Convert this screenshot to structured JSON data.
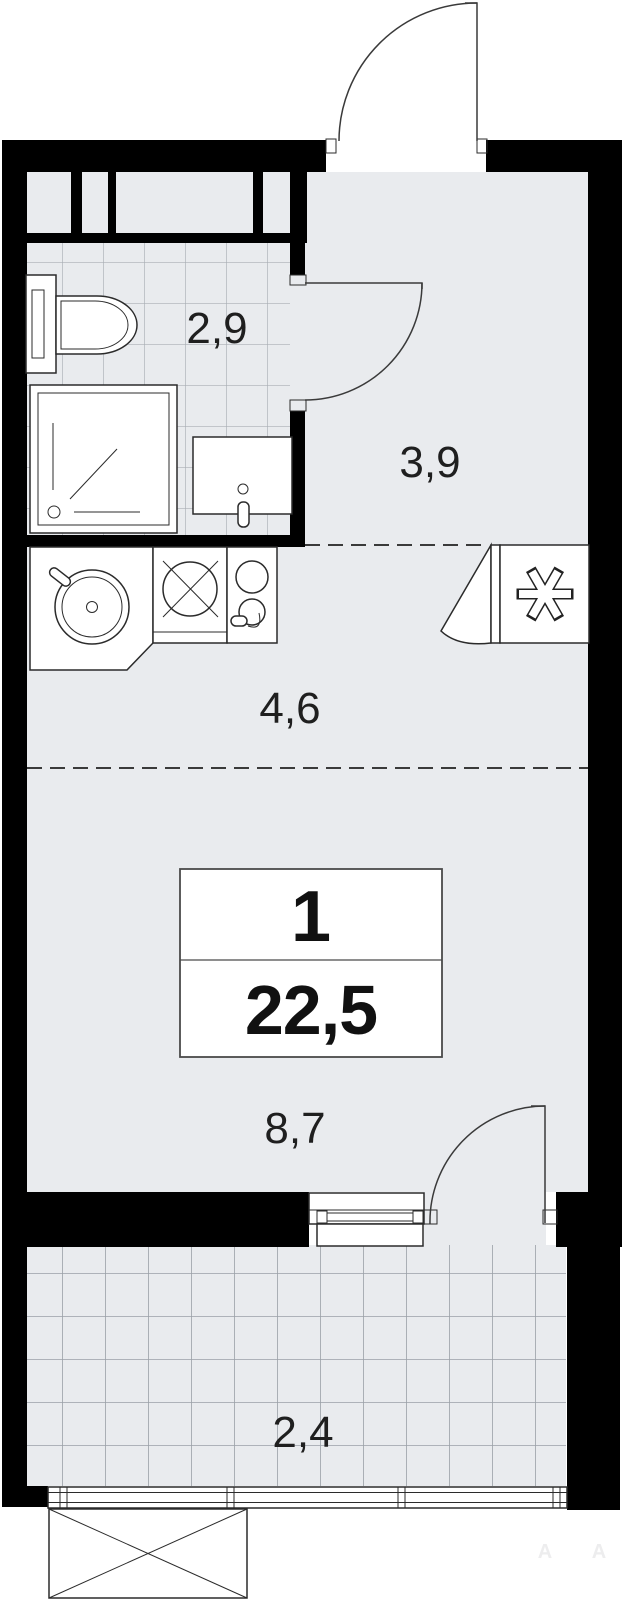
{
  "plan": {
    "title": "studio-apartment-floor-plan",
    "labels": {
      "bathroom": "2,9",
      "hallway": "3,9",
      "kitchen": "4,6",
      "living": "8,7",
      "balcony": "2,4"
    },
    "info_box": {
      "rooms": "1",
      "total_area": "22,5"
    },
    "watermark": {
      "letters": [
        "A",
        "A"
      ]
    },
    "colors": {
      "wall": "#000000",
      "floor": "#e9ebee",
      "tile_line": "#a9aeb5",
      "fixture_stroke": "#2b2b2b",
      "label_text": "#1f1f1f",
      "outside": "#ffffff",
      "dashed_line": "#3a3a3a"
    },
    "icons": [
      "fridge-snowflake-icon",
      "toilet-icon",
      "shower-icon",
      "washbasin-icon",
      "washing-machine-icon",
      "kitchen-sink-icon",
      "stove-icon",
      "door-swing-arc-icon",
      "window-icon",
      "crossed-box-icon"
    ]
  }
}
